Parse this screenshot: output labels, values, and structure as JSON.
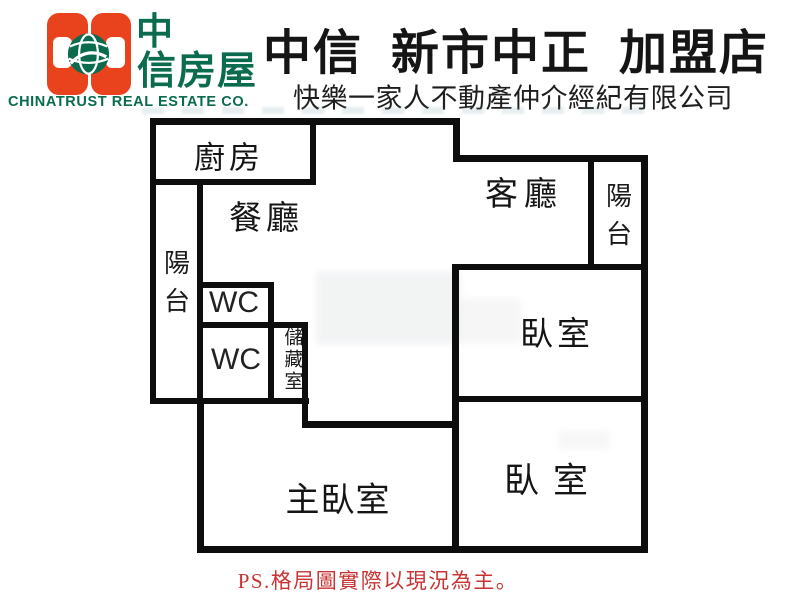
{
  "header": {
    "logo": {
      "zh_top": "中",
      "zh_bottom": "信房屋",
      "en": "CHINATRUST REAL ESTATE CO.",
      "colors": {
        "orange": "#E9431E",
        "green": "#0A6B4E"
      }
    },
    "title": "中信  新市中正  加盟店",
    "subtitle": "快樂一家人不動產仲介經紀有限公司"
  },
  "floorplan": {
    "wall_color": "#0d0d0d",
    "rooms": {
      "kitchen": "廚房",
      "dining": "餐廳",
      "living": "客廳",
      "balcony_left": "陽台",
      "balcony_right": "陽台",
      "wc1": "WC",
      "wc2": "WC",
      "storage": "儲藏室",
      "bedroom1": "臥室",
      "bedroom2": "臥室",
      "master_bedroom": "主臥室"
    }
  },
  "footer": {
    "note": "PS.格局圖實際以現況為主。",
    "color": "#C83333"
  }
}
